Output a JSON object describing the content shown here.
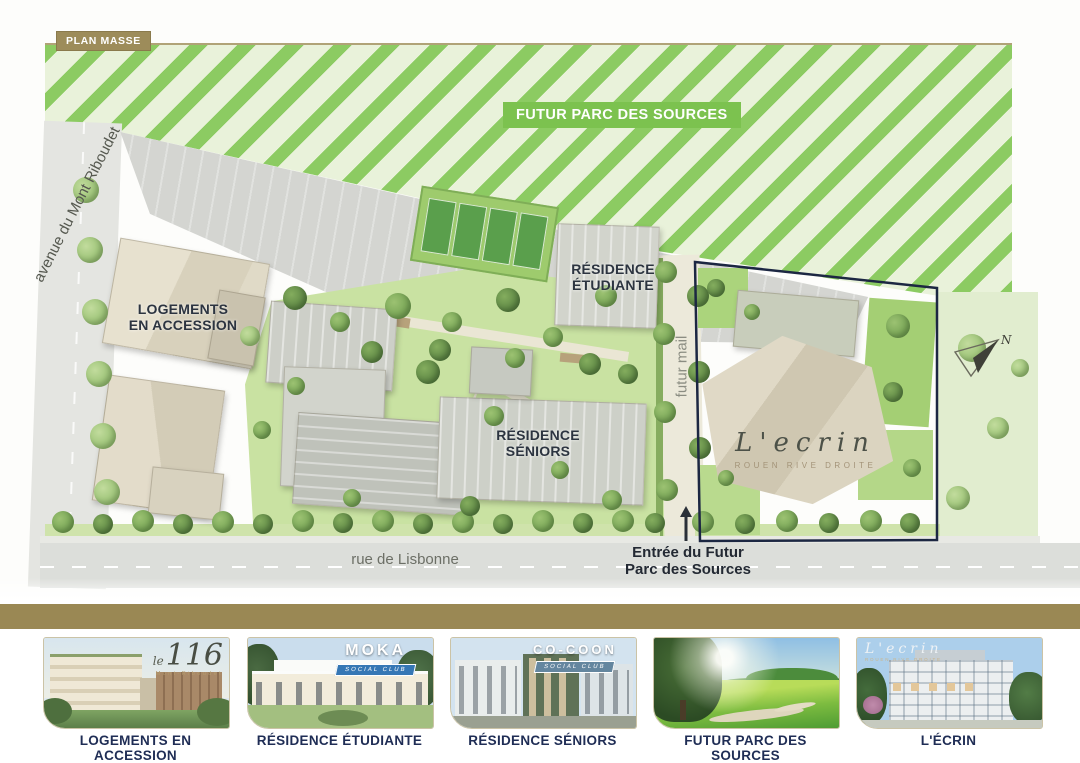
{
  "plan": {
    "badge": "PLAN MASSE",
    "park_banner": "FUTUR PARC DES SOURCES",
    "streets": {
      "avenue": "avenue du Mont Riboudet",
      "rue": "rue de Lisbonne",
      "mail": "futur mail"
    },
    "buildings": {
      "accession": {
        "line1": "LOGEMENTS",
        "line2": "EN ACCESSION"
      },
      "etudiante": {
        "line1": "RÉSIDENCE",
        "line2": "ÉTUDIANTE"
      },
      "seniors": {
        "line1": "RÉSIDENCE",
        "line2": "SÉNIORS"
      }
    },
    "entrance": {
      "line1": "Entrée du Futur",
      "line2": "Parc des Sources"
    },
    "north_label": "N",
    "lecrin": {
      "name": "L'ecrin",
      "subtitle": "ROUEN RIVE DROITE"
    }
  },
  "thumbnails": [
    {
      "caption": "LOGEMENTS EN ACCESSION",
      "logo": {
        "prefix": "le",
        "number": "116",
        "subtitle": "Mont-Riboudet"
      }
    },
    {
      "caption": "RÉSIDENCE ÉTUDIANTE",
      "logo": {
        "name": "MOKA",
        "subtitle": "SOCIAL CLUB"
      }
    },
    {
      "caption": "RÉSIDENCE SÉNIORS",
      "logo": {
        "name": "CO-COON",
        "subtitle": "SOCIAL CLUB"
      }
    },
    {
      "caption": "FUTUR PARC DES SOURCES"
    },
    {
      "caption": "L'ÉCRIN",
      "logo": {
        "name": "L'ecrin",
        "subtitle": "ROUEN RIVE DROITE"
      }
    }
  ],
  "colors": {
    "accent_gold": "#9A8854",
    "park_green": "#7CC24F",
    "stripe_green": "#8CCB62",
    "caption_navy": "#1F2D55",
    "outline_navy": "#1C2742"
  }
}
